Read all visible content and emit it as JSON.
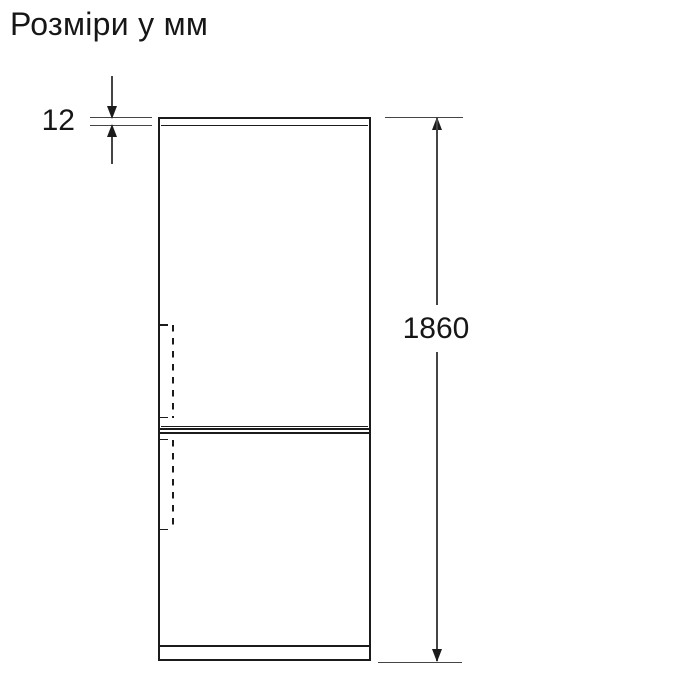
{
  "title": "Розміри у мм",
  "dimensions": {
    "top_panel_thickness_mm": "12",
    "overall_height_mm": "1860"
  },
  "colors": {
    "background": "#ffffff",
    "line": "#1b1b1b",
    "dim_line": "#454545",
    "text": "#161616"
  }
}
